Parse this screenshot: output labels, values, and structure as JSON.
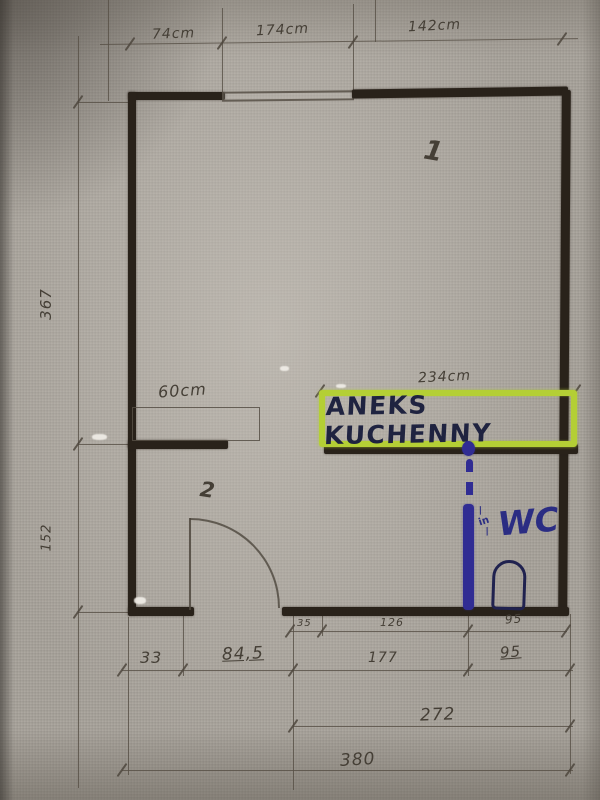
{
  "labels": {
    "kitchen_box": "ANEKS KUCHENNY",
    "wc": "WC",
    "in_mark": "in",
    "room1": "1",
    "room2": "2"
  },
  "dimensions": {
    "top": [
      "74cm",
      "174cm",
      "142cm"
    ],
    "left_total": "367",
    "left_lower": "152",
    "kitchen_width": "234cm",
    "counter": "60cm",
    "inner_row": [
      "35",
      "126",
      "95"
    ],
    "outer_row": [
      "33",
      "84,5",
      "177",
      "95"
    ],
    "span_row": "272",
    "total_row": "380"
  },
  "colors": {
    "highlighter": "#b4cf35",
    "marker_blue": "#302c93",
    "wall_ink": "#29221a",
    "pencil": "#4d463d",
    "paper": "#a7a29a"
  }
}
